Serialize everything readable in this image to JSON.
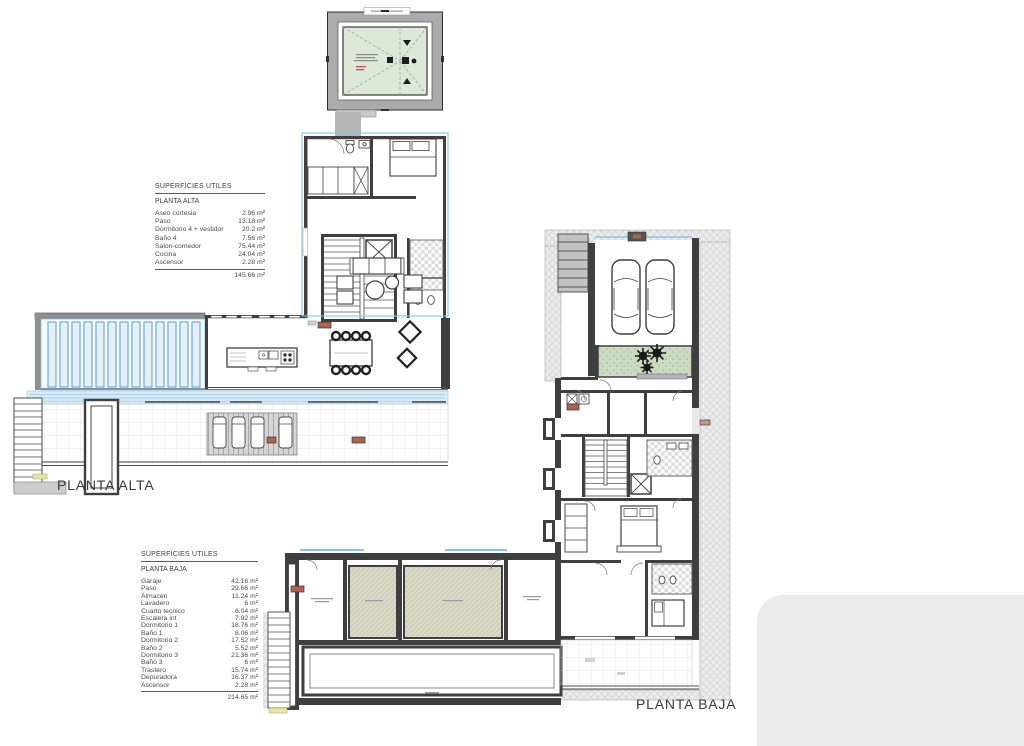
{
  "labels": {
    "planta_alta": "PLANTA ALTA",
    "planta_baja": "PLANTA BAJA"
  },
  "tables": {
    "alta": {
      "title": "SUPERFICIES UTILES",
      "subtitle": "PLANTA ALTA",
      "rows": [
        {
          "label": "Aseo cortesia",
          "value": "2.96 m²"
        },
        {
          "label": "Paso",
          "value": "13.18 m²"
        },
        {
          "label": "Dormitorio 4 + vestidor",
          "value": "20.2 m²"
        },
        {
          "label": "Baño 4",
          "value": "7.56 m²"
        },
        {
          "label": "Salon-comedor",
          "value": "75.44 m²"
        },
        {
          "label": "Cocina",
          "value": "24.04 m²"
        },
        {
          "label": "Ascensor",
          "value": "2.28 m²"
        }
      ],
      "total": "145.66 m²"
    },
    "baja": {
      "title": "SUPERFICIES UTILES",
      "subtitle": "PLANTA BAJA",
      "rows": [
        {
          "label": "Garaje",
          "value": "42.16 m²"
        },
        {
          "label": "Paso",
          "value": "29.66 m²"
        },
        {
          "label": "Almacen",
          "value": "11.24 m²"
        },
        {
          "label": "Lavadero",
          "value": "6 m²"
        },
        {
          "label": "Cuarto tecnico",
          "value": "6.04 m²"
        },
        {
          "label": "Escalera int",
          "value": "7.92 m²"
        },
        {
          "label": "Dormitorio 1",
          "value": "18.76 m²"
        },
        {
          "label": "Baño 1",
          "value": "8.06 m²"
        },
        {
          "label": "Dormitorio 2",
          "value": "17.52 m²"
        },
        {
          "label": "Baño 2",
          "value": "5.52 m²"
        },
        {
          "label": "Dormitorio 3",
          "value": "21.36 m²"
        },
        {
          "label": "Baño 3",
          "value": "6 m²"
        },
        {
          "label": "Trastero",
          "value": "15.74 m²"
        },
        {
          "label": "Depuradora",
          "value": "16.37 m²"
        },
        {
          "label": "Ascensor",
          "value": "2.28 m²"
        }
      ],
      "total": "214.65 m²"
    }
  },
  "colors": {
    "wall": "#3f3f3f",
    "pool_blue": "#d8eaf6",
    "stripe_blue": "#5b9bd5",
    "outline_blue": "#86c5e8",
    "roof_green": "#dce9d8",
    "patio_green": "#ccdcc2",
    "tech_room_beige": "#d9d9c6",
    "plot_hatch": "#ececec",
    "marker_red": "#b0614f"
  },
  "icons": {
    "tree": "starburst-shape",
    "car": "rounded-rect-outline",
    "bed": "rect-with-pillows",
    "stairs": "tread-lines"
  }
}
